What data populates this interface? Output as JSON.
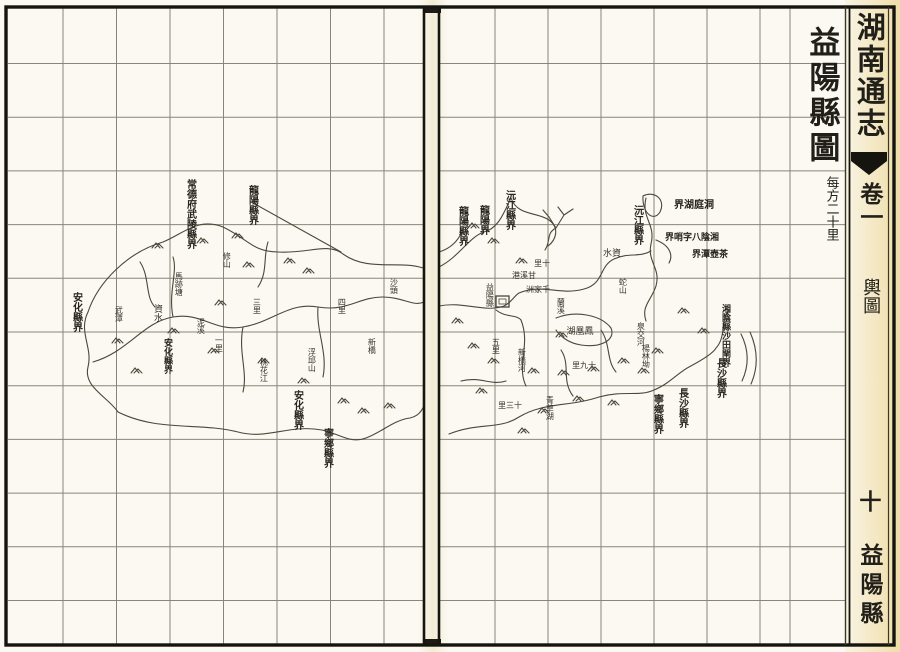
{
  "palette": {
    "paper": "#fbf9f1",
    "ink": "#35332a",
    "map_stroke": "#4a483a",
    "grid_line": "#8a8578",
    "frame": "#16140f",
    "aged": "#e6c76e"
  },
  "spine": {
    "book_title": "湖南通志",
    "chapter": "卷一",
    "section": "輿圖",
    "page_number": "十",
    "page_label": "益陽縣"
  },
  "title_block": {
    "map_title": "益陽縣圖",
    "scale_note": "每方二十里"
  },
  "map": {
    "county_seat_label": "益陽縣",
    "labels": [
      {
        "text": "常德府武陵縣界",
        "x": 190,
        "y": 179,
        "o": "v",
        "s": 10,
        "h": 58,
        "b": 1
      },
      {
        "text": "龍陽縣界",
        "x": 252,
        "y": 185,
        "o": "v",
        "s": 10,
        "h": 32,
        "b": 1
      },
      {
        "text": "安化縣界",
        "x": 76,
        "y": 292,
        "o": "v",
        "s": 10,
        "b": 1
      },
      {
        "text": "資水",
        "x": 156,
        "y": 304,
        "o": "v",
        "s": 9
      },
      {
        "text": "安化縣界",
        "x": 166,
        "y": 338,
        "o": "v",
        "s": 9,
        "b": 1
      },
      {
        "text": "安化縣界",
        "x": 297,
        "y": 390,
        "o": "v",
        "s": 10,
        "b": 1
      },
      {
        "text": "寧鄉縣界",
        "x": 327,
        "y": 428,
        "o": "v",
        "s": 10,
        "b": 1
      },
      {
        "text": "馬跡塘",
        "x": 178,
        "y": 272,
        "o": "v",
        "s": 8
      },
      {
        "text": "武潭",
        "x": 118,
        "y": 306,
        "o": "v",
        "s": 8
      },
      {
        "text": "修山",
        "x": 226,
        "y": 252,
        "o": "v",
        "s": 8
      },
      {
        "text": "泥溪",
        "x": 200,
        "y": 318,
        "o": "v",
        "s": 8
      },
      {
        "text": "一里",
        "x": 218,
        "y": 336,
        "o": "v",
        "s": 8
      },
      {
        "text": "三里",
        "x": 256,
        "y": 298,
        "o": "v",
        "s": 8
      },
      {
        "text": "桃花江",
        "x": 263,
        "y": 358,
        "o": "v",
        "s": 8
      },
      {
        "text": "浮邱山",
        "x": 311,
        "y": 348,
        "o": "v",
        "s": 8
      },
      {
        "text": "四里",
        "x": 341,
        "y": 298,
        "o": "v",
        "s": 8
      },
      {
        "text": "沙頭",
        "x": 393,
        "y": 278,
        "o": "v",
        "s": 8
      },
      {
        "text": "新橋",
        "x": 371,
        "y": 338,
        "o": "v",
        "s": 8
      },
      {
        "text": "龍陽縣界",
        "x": 462,
        "y": 206,
        "o": "v",
        "s": 10,
        "b": 1
      },
      {
        "text": "龍陽界",
        "x": 483,
        "y": 205,
        "o": "v",
        "s": 10,
        "b": 1
      },
      {
        "text": "沅江縣界",
        "x": 509,
        "y": 190,
        "o": "v",
        "s": 10,
        "b": 1
      },
      {
        "text": "沅江縣界",
        "x": 637,
        "y": 205,
        "o": "v",
        "s": 10,
        "b": 1
      },
      {
        "text": "洞庭湖界",
        "x": 694,
        "y": 200,
        "o": "h",
        "s": 10,
        "b": 1
      },
      {
        "text": "湘陰八字哨界",
        "x": 692,
        "y": 234,
        "o": "h",
        "s": 9,
        "b": 1
      },
      {
        "text": "茶壺潭界",
        "x": 710,
        "y": 251,
        "o": "h",
        "s": 9,
        "b": 1
      },
      {
        "text": "湘陰縣沙田閘界",
        "x": 724,
        "y": 304,
        "o": "v",
        "s": 9,
        "h": 56,
        "b": 1
      },
      {
        "text": "長沙縣界",
        "x": 720,
        "y": 358,
        "o": "v",
        "s": 10,
        "b": 1
      },
      {
        "text": "長沙縣界",
        "x": 682,
        "y": 388,
        "o": "v",
        "s": 10,
        "b": 1
      },
      {
        "text": "寧鄉縣界",
        "x": 657,
        "y": 394,
        "o": "v",
        "s": 10,
        "b": 1
      },
      {
        "text": "資水",
        "x": 612,
        "y": 250,
        "o": "h",
        "s": 9
      },
      {
        "text": "鳳凰湖",
        "x": 580,
        "y": 328,
        "o": "h",
        "s": 9
      },
      {
        "text": "十九里",
        "x": 584,
        "y": 362,
        "o": "h",
        "s": 8
      },
      {
        "text": "十三里",
        "x": 510,
        "y": 402,
        "o": "h",
        "s": 8
      },
      {
        "text": "青草湖",
        "x": 549,
        "y": 396,
        "o": "v",
        "s": 8
      },
      {
        "text": "益陽縣",
        "x": 489,
        "y": 283,
        "o": "v",
        "s": 8
      },
      {
        "text": "甘溪港",
        "x": 524,
        "y": 272,
        "o": "h",
        "s": 8
      },
      {
        "text": "千家洲",
        "x": 538,
        "y": 286,
        "o": "h",
        "s": 8
      },
      {
        "text": "十里",
        "x": 542,
        "y": 260,
        "o": "h",
        "s": 8
      },
      {
        "text": "泉交河",
        "x": 640,
        "y": 322,
        "o": "v",
        "s": 8
      },
      {
        "text": "蛇山",
        "x": 622,
        "y": 278,
        "o": "v",
        "s": 8
      },
      {
        "text": "蘭溪",
        "x": 560,
        "y": 298,
        "o": "v",
        "s": 8
      },
      {
        "text": "新橋河",
        "x": 521,
        "y": 348,
        "o": "v",
        "s": 8
      },
      {
        "text": "楊林坳",
        "x": 645,
        "y": 344,
        "o": "v",
        "s": 8
      },
      {
        "text": "五里",
        "x": 495,
        "y": 338,
        "o": "v",
        "s": 8
      }
    ]
  }
}
